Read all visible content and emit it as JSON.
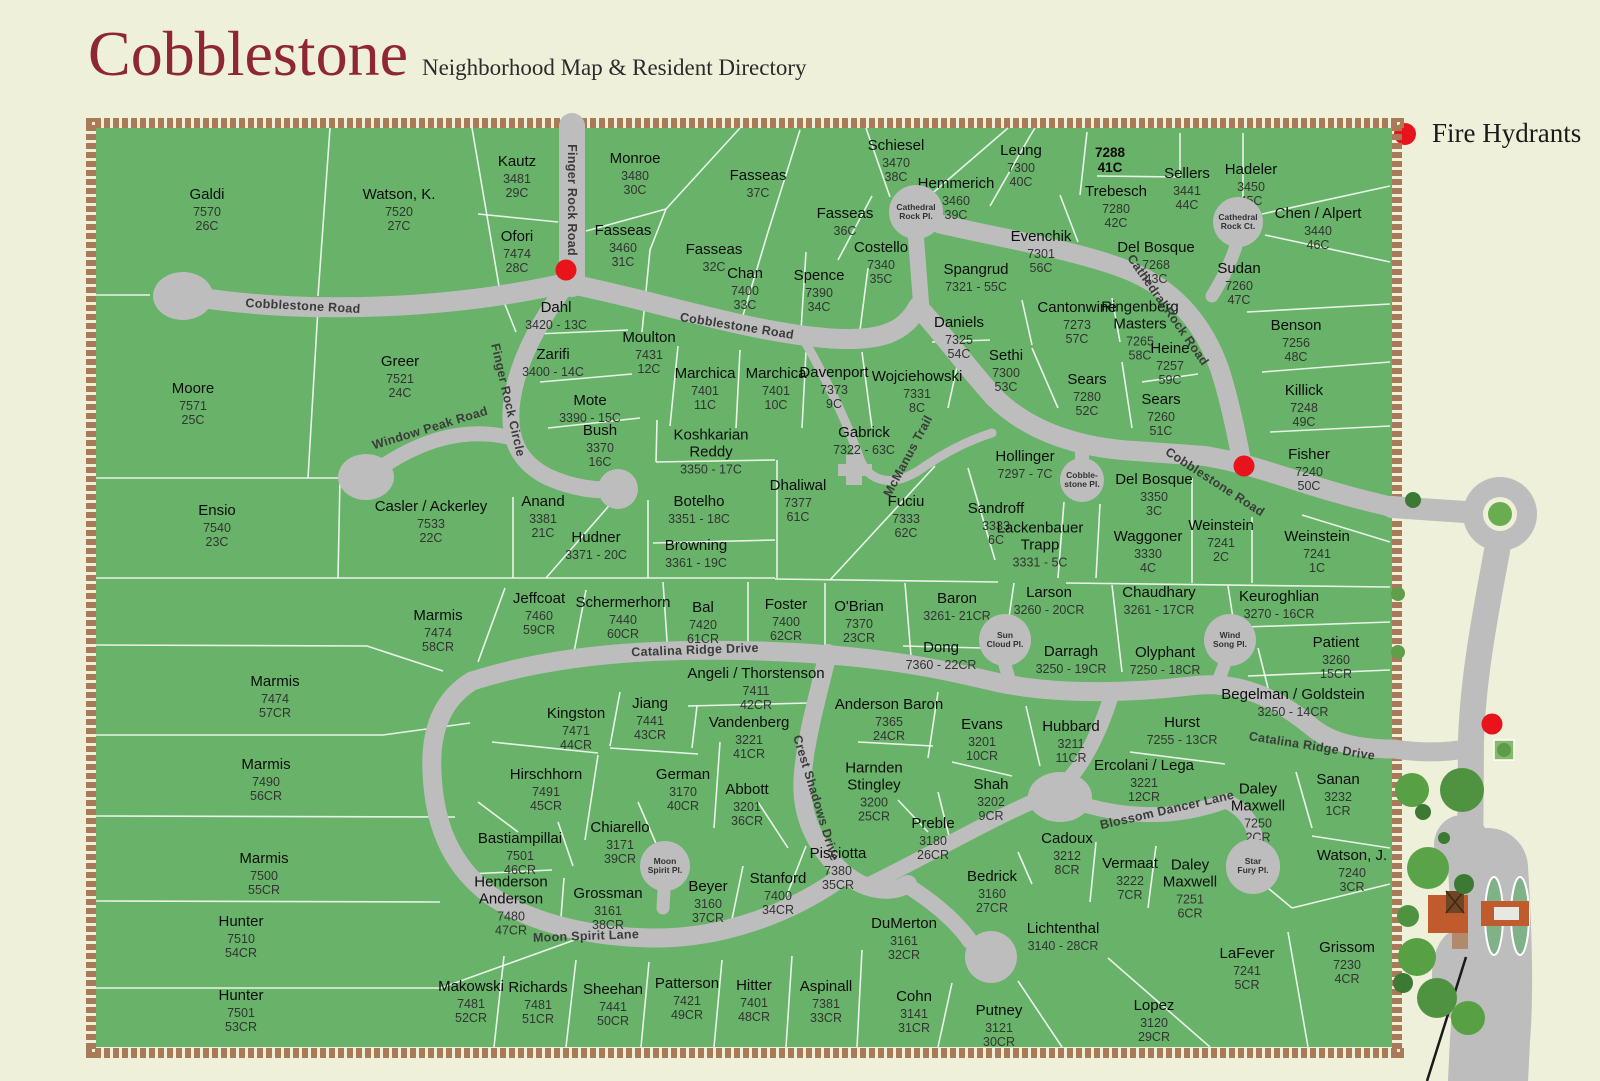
{
  "title": {
    "main": "Cobblestone",
    "sub": "Neighborhood Map & Resident Directory"
  },
  "legend": {
    "label": "Fire Hydrants"
  },
  "colors": {
    "background": "#eef0da",
    "map_green": "#68b269",
    "road_gray": "#bdbdbd",
    "parcel_line": "#ffffff",
    "brick": "#a87a57",
    "title_maroon": "#8e2633",
    "hydrant_red": "#e8131b",
    "tree_green": "#4f9340",
    "building_orange": "#bf5b2d"
  },
  "lots": [
    {
      "name": "Galdi",
      "num": "7570\n26C",
      "x": 207,
      "y": 210
    },
    {
      "name": "Watson, K.",
      "num": "7520\n27C",
      "x": 399,
      "y": 210
    },
    {
      "name": "Kautz",
      "num": "3481\n29C",
      "x": 517,
      "y": 177
    },
    {
      "name": "Monroe",
      "num": "3480\n30C",
      "x": 635,
      "y": 174
    },
    {
      "name": "Fasseas",
      "num": "37C",
      "x": 758,
      "y": 184
    },
    {
      "name": "Schiesel",
      "num": "3470\n38C",
      "x": 896,
      "y": 161
    },
    {
      "name": "Hemmerich",
      "num": "3460\n39C",
      "x": 956,
      "y": 199
    },
    {
      "name": "Leung",
      "num": "7300\n40C",
      "x": 1021,
      "y": 166
    },
    {
      "name": "7288\n41C",
      "num": "",
      "x": 1110,
      "y": 160,
      "bold": true
    },
    {
      "name": "Sellers",
      "num": "3441\n44C",
      "x": 1187,
      "y": 189
    },
    {
      "name": "Hadeler",
      "num": "3450\n45C",
      "x": 1251,
      "y": 185
    },
    {
      "name": "Trebesch",
      "num": "7280\n42C",
      "x": 1116,
      "y": 207
    },
    {
      "name": "Chen / Alpert",
      "num": "3440\n46C",
      "x": 1318,
      "y": 229
    },
    {
      "name": "Del Bosque",
      "num": "7268\n43C",
      "x": 1156,
      "y": 263
    },
    {
      "name": "Sudan",
      "num": "7260\n47C",
      "x": 1239,
      "y": 284
    },
    {
      "name": "Ofori",
      "num": "7474\n28C",
      "x": 517,
      "y": 252
    },
    {
      "name": "Fasseas",
      "num": "3460\n31C",
      "x": 623,
      "y": 246
    },
    {
      "name": "Fasseas",
      "num": "32C",
      "x": 714,
      "y": 258
    },
    {
      "name": "Fasseas",
      "num": "36C",
      "x": 845,
      "y": 222
    },
    {
      "name": "Chan",
      "num": "7400\n33C",
      "x": 745,
      "y": 289
    },
    {
      "name": "Spence",
      "num": "7390\n34C",
      "x": 819,
      "y": 291
    },
    {
      "name": "Costello",
      "num": "7340\n35C",
      "x": 881,
      "y": 263
    },
    {
      "name": "Evenchik",
      "num": "7301\n56C",
      "x": 1041,
      "y": 252
    },
    {
      "name": "Spangrud",
      "num": "7321 - 55C",
      "x": 976,
      "y": 278
    },
    {
      "name": "Dahl",
      "num": "3420 - 13C",
      "x": 556,
      "y": 316
    },
    {
      "name": "Daniels",
      "num": "7325\n54C",
      "x": 959,
      "y": 338
    },
    {
      "name": "Cantonwine",
      "num": "7273\n57C",
      "x": 1077,
      "y": 323
    },
    {
      "name": "Ringenberg\nMasters",
      "num": "7265\n58C",
      "x": 1140,
      "y": 331
    },
    {
      "name": "Benson",
      "num": "7256\n48C",
      "x": 1296,
      "y": 341
    },
    {
      "name": "Sethi",
      "num": "7300\n53C",
      "x": 1006,
      "y": 371
    },
    {
      "name": "Heine",
      "num": "7257\n59C",
      "x": 1170,
      "y": 364
    },
    {
      "name": "Sears",
      "num": "7280\n52C",
      "x": 1087,
      "y": 395
    },
    {
      "name": "Sears",
      "num": "7260\n51C",
      "x": 1161,
      "y": 415
    },
    {
      "name": "Killick",
      "num": "7248\n49C",
      "x": 1304,
      "y": 406
    },
    {
      "name": "Moulton",
      "num": "7431\n12C",
      "x": 649,
      "y": 353
    },
    {
      "name": "Zarifi",
      "num": "3400 - 14C",
      "x": 553,
      "y": 363
    },
    {
      "name": "Marchica",
      "num": "7401\n11C",
      "x": 705,
      "y": 389
    },
    {
      "name": "Marchica",
      "num": "7401\n10C",
      "x": 776,
      "y": 389
    },
    {
      "name": "Davenport",
      "num": "7373\n9C",
      "x": 834,
      "y": 388
    },
    {
      "name": "Wojciehowski",
      "num": "7331\n8C",
      "x": 917,
      "y": 392
    },
    {
      "name": "Mote",
      "num": "3390 - 15C",
      "x": 590,
      "y": 409
    },
    {
      "name": "Greer",
      "num": "7521\n24C",
      "x": 400,
      "y": 377
    },
    {
      "name": "Moore",
      "num": "7571\n25C",
      "x": 193,
      "y": 404
    },
    {
      "name": "Bush",
      "num": "3370\n16C",
      "x": 600,
      "y": 446
    },
    {
      "name": "Koshkarian\nReddy",
      "num": "3350 - 17C",
      "x": 711,
      "y": 452
    },
    {
      "name": "Gabrick",
      "num": "7322 - 63C",
      "x": 864,
      "y": 441
    },
    {
      "name": "Hollinger",
      "num": "7297 - 7C",
      "x": 1025,
      "y": 465
    },
    {
      "name": "Fisher",
      "num": "7240\n50C",
      "x": 1309,
      "y": 470
    },
    {
      "name": "Ensio",
      "num": "7540\n23C",
      "x": 217,
      "y": 526
    },
    {
      "name": "Casler / Ackerley",
      "num": "7533\n22C",
      "x": 431,
      "y": 522
    },
    {
      "name": "Anand",
      "num": "3381\n21C",
      "x": 543,
      "y": 517
    },
    {
      "name": "Hudner",
      "num": "3371 - 20C",
      "x": 596,
      "y": 546
    },
    {
      "name": "Botelho",
      "num": "3351 - 18C",
      "x": 699,
      "y": 510
    },
    {
      "name": "Browning",
      "num": "3361 - 19C",
      "x": 696,
      "y": 554
    },
    {
      "name": "Dhaliwal",
      "num": "7377\n61C",
      "x": 798,
      "y": 501
    },
    {
      "name": "Fuciu",
      "num": "7333\n62C",
      "x": 906,
      "y": 517
    },
    {
      "name": "Sandroff",
      "num": "3333\n6C",
      "x": 996,
      "y": 524
    },
    {
      "name": "Lackenbauer\nTrapp",
      "num": "3331 - 5C",
      "x": 1040,
      "y": 545
    },
    {
      "name": "Del Bosque",
      "num": "3350\n3C",
      "x": 1154,
      "y": 495
    },
    {
      "name": "Waggoner",
      "num": "3330\n4C",
      "x": 1148,
      "y": 552
    },
    {
      "name": "Weinstein",
      "num": "7241\n2C",
      "x": 1221,
      "y": 541
    },
    {
      "name": "Weinstein",
      "num": "7241\n1C",
      "x": 1317,
      "y": 552
    },
    {
      "name": "Jeffcoat",
      "num": "7460\n59CR",
      "x": 539,
      "y": 614
    },
    {
      "name": "Schermerhorn",
      "num": "7440\n60CR",
      "x": 623,
      "y": 618
    },
    {
      "name": "Bal",
      "num": "7420\n61CR",
      "x": 703,
      "y": 623
    },
    {
      "name": "Foster",
      "num": "7400\n62CR",
      "x": 786,
      "y": 620
    },
    {
      "name": "O'Brian",
      "num": "7370\n23CR",
      "x": 859,
      "y": 622
    },
    {
      "name": "Baron",
      "num": "3261- 21CR",
      "x": 957,
      "y": 607
    },
    {
      "name": "Dong",
      "num": "7360 - 22CR",
      "x": 941,
      "y": 656
    },
    {
      "name": "Larson",
      "num": "3260 - 20CR",
      "x": 1049,
      "y": 601
    },
    {
      "name": "Chaudhary",
      "num": "3261 - 17CR",
      "x": 1159,
      "y": 601
    },
    {
      "name": "Keuroghlian",
      "num": "3270 - 16CR",
      "x": 1279,
      "y": 605
    },
    {
      "name": "Darragh",
      "num": "3250 - 19CR",
      "x": 1071,
      "y": 660
    },
    {
      "name": "Olyphant",
      "num": "7250 - 18CR",
      "x": 1165,
      "y": 661
    },
    {
      "name": "Patient",
      "num": "3260\n15CR",
      "x": 1336,
      "y": 658
    },
    {
      "name": "Begelman / Goldstein",
      "num": "3250 - 14CR",
      "x": 1293,
      "y": 703
    },
    {
      "name": "Marmis",
      "num": "7474\n58CR",
      "x": 438,
      "y": 631
    },
    {
      "name": "Marmis",
      "num": "7474\n57CR",
      "x": 275,
      "y": 697
    },
    {
      "name": "Marmis",
      "num": "7490\n56CR",
      "x": 266,
      "y": 780
    },
    {
      "name": "Marmis",
      "num": "7500\n55CR",
      "x": 264,
      "y": 874
    },
    {
      "name": "Hunter",
      "num": "7510\n54CR",
      "x": 241,
      "y": 937
    },
    {
      "name": "Hunter",
      "num": "7501\n53CR",
      "x": 241,
      "y": 1011
    },
    {
      "name": "Angeli / Thorstenson",
      "num": "7411\n42CR",
      "x": 756,
      "y": 689
    },
    {
      "name": "Jiang",
      "num": "7441\n43CR",
      "x": 650,
      "y": 719
    },
    {
      "name": "Kingston",
      "num": "7471\n44CR",
      "x": 576,
      "y": 729
    },
    {
      "name": "Vandenberg",
      "num": "3221\n41CR",
      "x": 749,
      "y": 738
    },
    {
      "name": "Anderson Baron",
      "num": "7365\n24CR",
      "x": 889,
      "y": 720
    },
    {
      "name": "Harnden\nStingley",
      "num": "3200\n25CR",
      "x": 874,
      "y": 792
    },
    {
      "name": "Hirschhorn",
      "num": "7491\n45CR",
      "x": 546,
      "y": 790
    },
    {
      "name": "German",
      "num": "3170\n40CR",
      "x": 683,
      "y": 790
    },
    {
      "name": "Abbott",
      "num": "3201\n36CR",
      "x": 747,
      "y": 805
    },
    {
      "name": "Chiarello",
      "num": "3171\n39CR",
      "x": 620,
      "y": 843
    },
    {
      "name": "Bastiampillai",
      "num": "7501\n46CR",
      "x": 520,
      "y": 854
    },
    {
      "name": "Henderson\nAnderson",
      "num": "7480\n47CR",
      "x": 511,
      "y": 906
    },
    {
      "name": "Grossman",
      "num": "3161\n38CR",
      "x": 608,
      "y": 909
    },
    {
      "name": "Beyer",
      "num": "3160\n37CR",
      "x": 708,
      "y": 902
    },
    {
      "name": "Stanford",
      "num": "7400\n34CR",
      "x": 778,
      "y": 894
    },
    {
      "name": "Pisciotta",
      "num": "7380\n35CR",
      "x": 838,
      "y": 869
    },
    {
      "name": "Preble",
      "num": "3180\n26CR",
      "x": 933,
      "y": 839
    },
    {
      "name": "Shah",
      "num": "3202\n9CR",
      "x": 991,
      "y": 800
    },
    {
      "name": "Evans",
      "num": "3201\n10CR",
      "x": 982,
      "y": 740
    },
    {
      "name": "Hubbard",
      "num": "3211\n11CR",
      "x": 1071,
      "y": 742
    },
    {
      "name": "Hurst",
      "num": "7255 - 13CR",
      "x": 1182,
      "y": 731
    },
    {
      "name": "Ercolani / Lega",
      "num": "3221\n12CR",
      "x": 1144,
      "y": 781
    },
    {
      "name": "Cadoux",
      "num": "3212\n8CR",
      "x": 1067,
      "y": 854
    },
    {
      "name": "Vermaat",
      "num": "3222\n7CR",
      "x": 1130,
      "y": 879
    },
    {
      "name": "Daley\nMaxwell",
      "num": "7250\n2CR",
      "x": 1258,
      "y": 813
    },
    {
      "name": "Daley\nMaxwell",
      "num": "7251\n6CR",
      "x": 1190,
      "y": 889
    },
    {
      "name": "Sanan",
      "num": "3232\n1CR",
      "x": 1338,
      "y": 795
    },
    {
      "name": "Watson, J.",
      "num": "7240\n3CR",
      "x": 1352,
      "y": 871
    },
    {
      "name": "Bedrick",
      "num": "3160\n27CR",
      "x": 992,
      "y": 892
    },
    {
      "name": "DuMerton",
      "num": "3161\n32CR",
      "x": 904,
      "y": 939
    },
    {
      "name": "Lichtenthal",
      "num": "3140 - 28CR",
      "x": 1063,
      "y": 937
    },
    {
      "name": "LaFever",
      "num": "7241\n5CR",
      "x": 1247,
      "y": 969
    },
    {
      "name": "Grissom",
      "num": "7230\n4CR",
      "x": 1347,
      "y": 963
    },
    {
      "name": "Cohn",
      "num": "3141\n31CR",
      "x": 914,
      "y": 1012
    },
    {
      "name": "Putney",
      "num": "3121\n30CR",
      "x": 999,
      "y": 1026
    },
    {
      "name": "Lopez",
      "num": "3120\n29CR",
      "x": 1154,
      "y": 1021
    },
    {
      "name": "Makowski",
      "num": "7481\n52CR",
      "x": 471,
      "y": 1002
    },
    {
      "name": "Richards",
      "num": "7481\n51CR",
      "x": 538,
      "y": 1003
    },
    {
      "name": "Sheehan",
      "num": "7441\n50CR",
      "x": 613,
      "y": 1005
    },
    {
      "name": "Patterson",
      "num": "7421\n49CR",
      "x": 687,
      "y": 999
    },
    {
      "name": "Hitter",
      "num": "7401\n48CR",
      "x": 754,
      "y": 1001
    },
    {
      "name": "Aspinall",
      "num": "7381\n33CR",
      "x": 826,
      "y": 1002
    }
  ],
  "road_labels": [
    {
      "text": "Cobblestone Road",
      "x": 303,
      "y": 306,
      "rot": 3
    },
    {
      "text": "Cobblestone Road",
      "x": 737,
      "y": 326,
      "rot": 9
    },
    {
      "text": "Cobblestone Road",
      "x": 1215,
      "y": 482,
      "rot": 33
    },
    {
      "text": "Finger Rock Road",
      "x": 572,
      "y": 200,
      "rot": 90
    },
    {
      "text": "Finger Rock Circle",
      "x": 508,
      "y": 400,
      "rot": 77
    },
    {
      "text": "Window Peak Road",
      "x": 430,
      "y": 428,
      "rot": -17
    },
    {
      "text": "Cathedral Rock Road",
      "x": 1168,
      "y": 310,
      "rot": 55
    },
    {
      "text": "McManus Trail",
      "x": 908,
      "y": 456,
      "rot": -62
    },
    {
      "text": "Catalina Ridge Drive",
      "x": 695,
      "y": 650,
      "rot": -2
    },
    {
      "text": "Catalina Ridge Drive",
      "x": 1312,
      "y": 746,
      "rot": 9
    },
    {
      "text": "Crest Shadows Drive",
      "x": 816,
      "y": 798,
      "rot": 73
    },
    {
      "text": "Blossom Dancer Lane",
      "x": 1167,
      "y": 810,
      "rot": -13
    },
    {
      "text": "Moon Spirit Lane",
      "x": 586,
      "y": 936,
      "rot": -2
    }
  ],
  "places": [
    {
      "text": "Cathedral\nRock Pl.",
      "x": 916,
      "y": 212,
      "r": 27
    },
    {
      "text": "Cathedral\nRock Ct.",
      "x": 1238,
      "y": 222,
      "r": 25
    },
    {
      "text": "Cobble-\nstone Pl.",
      "x": 1082,
      "y": 480,
      "r": 22
    },
    {
      "text": "Sun\nCloud Pl.",
      "x": 1005,
      "y": 640,
      "r": 26
    },
    {
      "text": "Wind\nSong Pl.",
      "x": 1230,
      "y": 640,
      "r": 26
    },
    {
      "text": "Moon\nSpirit Pl.",
      "x": 665,
      "y": 866,
      "r": 25
    },
    {
      "text": "Star\nFury Pl.",
      "x": 1253,
      "y": 866,
      "r": 27
    }
  ],
  "hydrants": [
    {
      "x": 566,
      "y": 270
    },
    {
      "x": 1244,
      "y": 466
    },
    {
      "x": 1492,
      "y": 724
    }
  ]
}
